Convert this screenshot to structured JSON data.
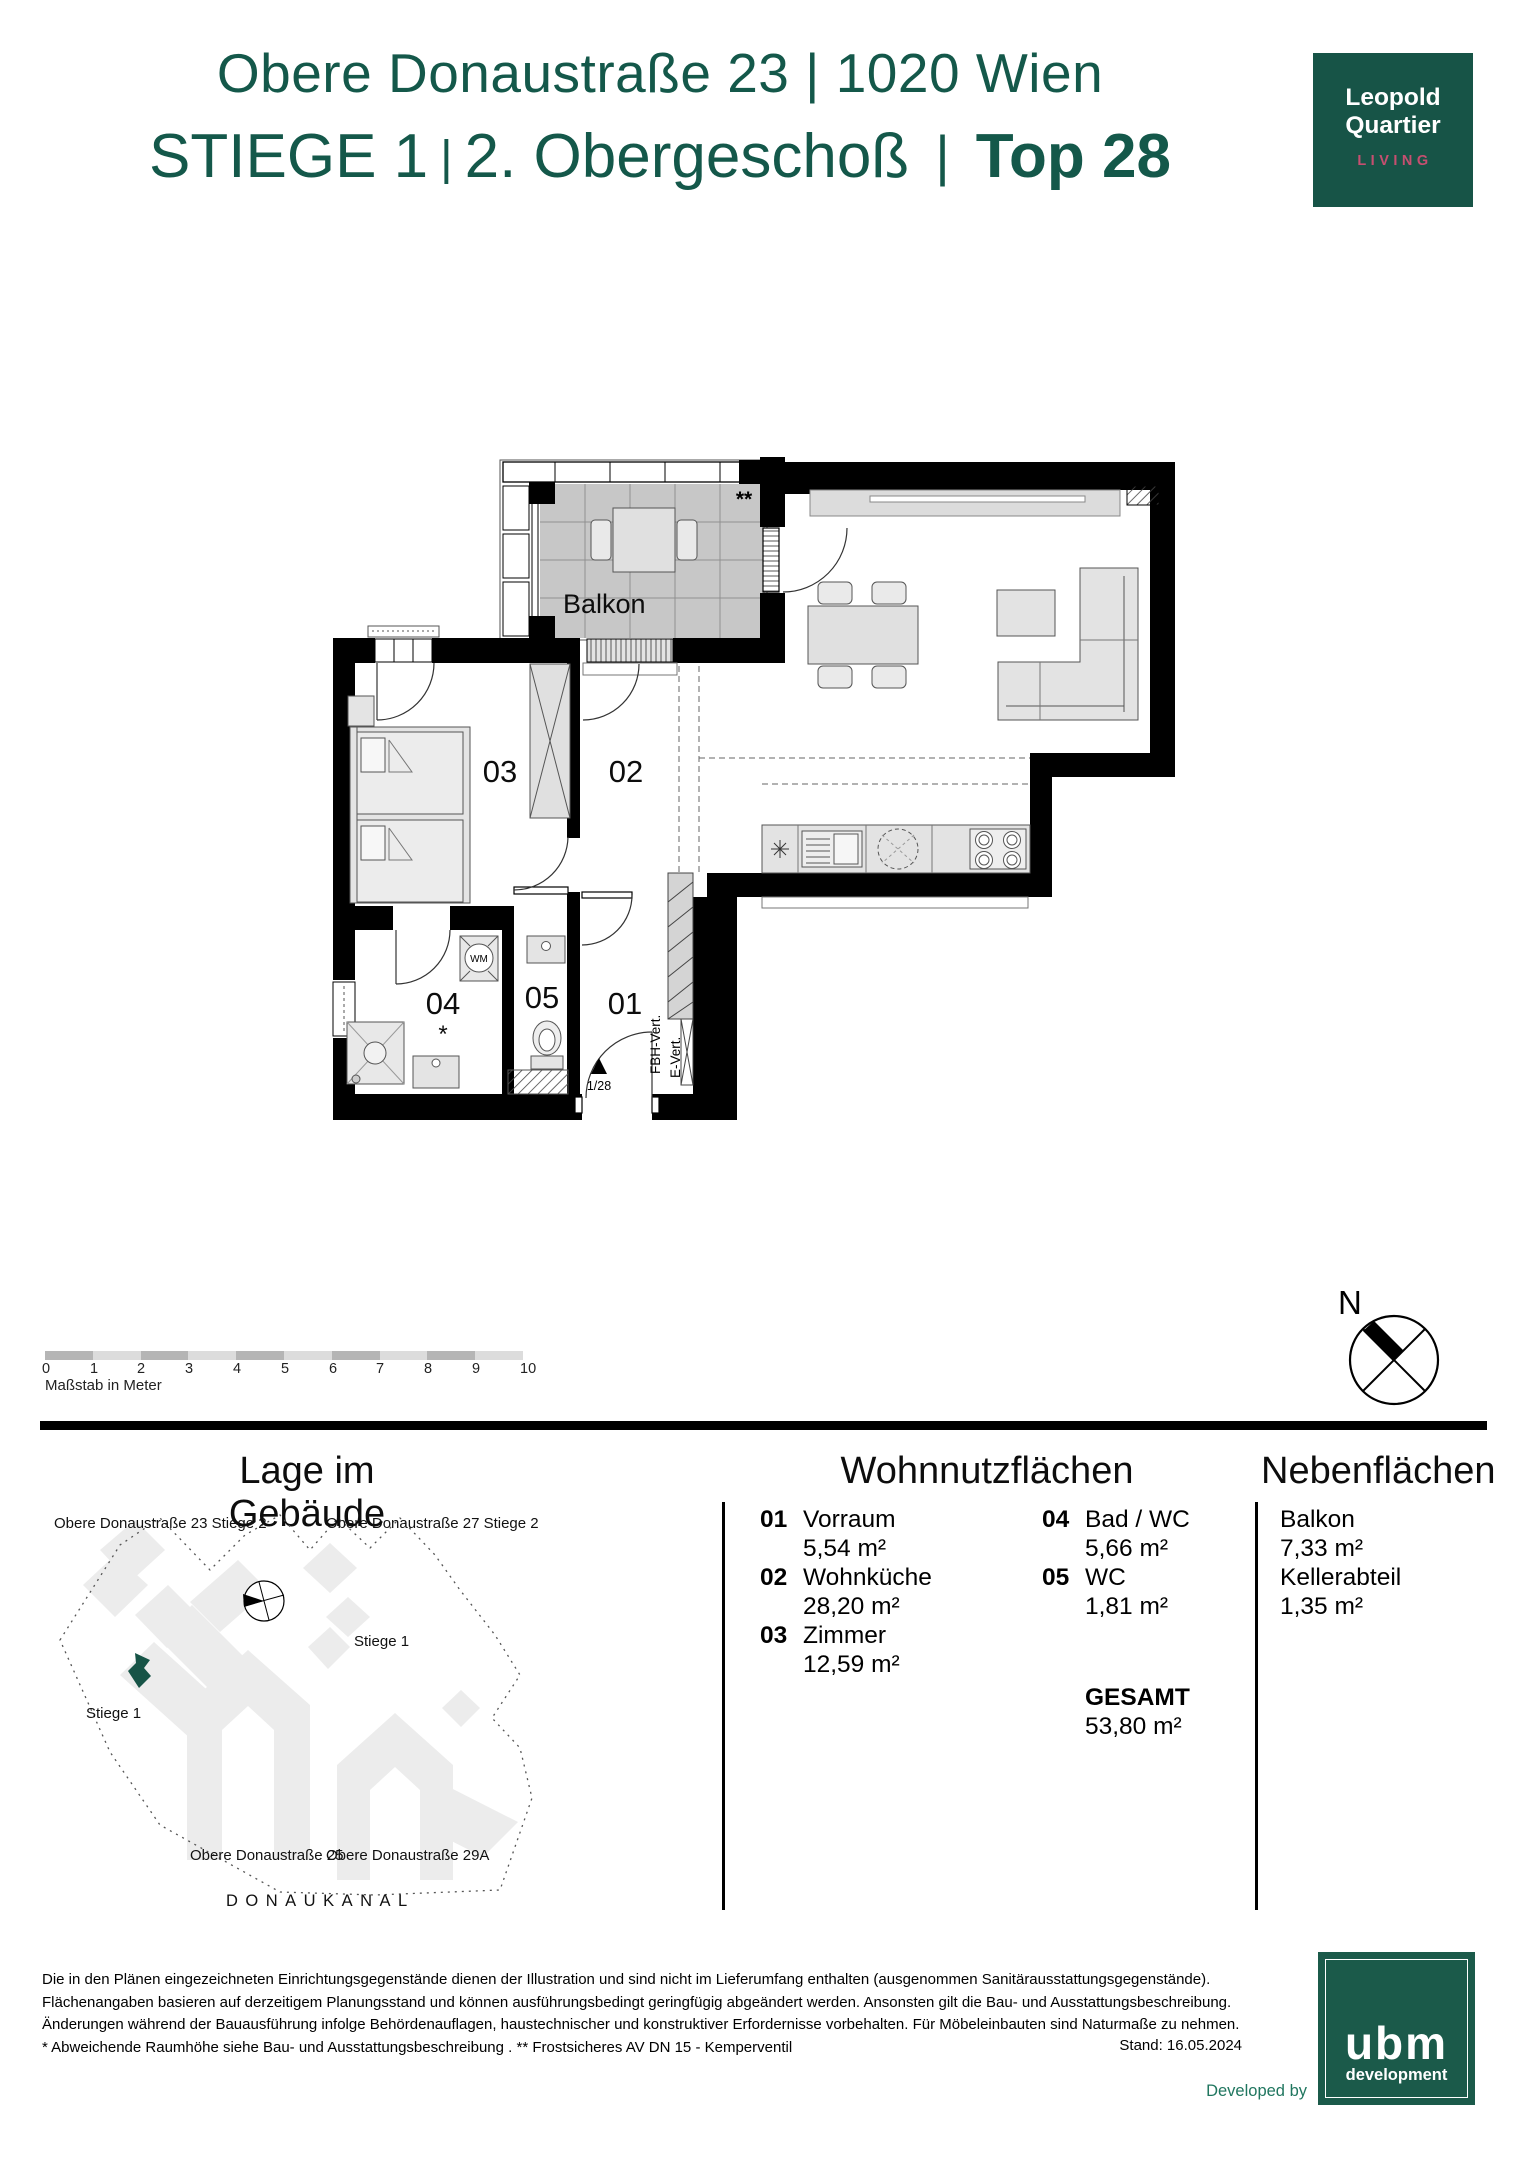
{
  "header": {
    "address": "Obere Donaustraße 23 | 1020 Wien",
    "title_part1": "STIEGE 1",
    "title_sep1": "|",
    "title_part2": "2. Obergeschoß",
    "title_sep2": "|",
    "title_part3": "Top 28"
  },
  "brand": {
    "line1": "Leopold",
    "line2": "Quartier",
    "tagline": "LIVING"
  },
  "plan": {
    "balcony_label": "Balkon",
    "room_labels": {
      "r01": "01",
      "r02": "02",
      "r03": "03",
      "r04": "04",
      "r05": "05"
    },
    "annotations": {
      "double_star": "**",
      "star": "*",
      "wm": "WM",
      "entrance_no": "1/28",
      "fbh": "FBH-Vert.",
      "evert": "E-Vert."
    }
  },
  "scalebar": {
    "ticks": [
      "0",
      "1",
      "2",
      "3",
      "4",
      "5",
      "6",
      "7",
      "8",
      "9",
      "10"
    ],
    "caption": "Maßstab in Meter"
  },
  "compass": {
    "north": "N"
  },
  "site_plan": {
    "title": "Lage im Gebäude",
    "labels": {
      "top_left": "Obere Donaustraße 23 Stiege 2",
      "top_right": "Obere Donaustraße 27 Stiege 2",
      "stiege_right": "Stiege 1",
      "stiege_left": "Stiege 1",
      "bottom_left": "Obere Donaustraße 25",
      "bottom_right": "Obere Donaustraße 29A",
      "canal": "DONAUKANAL"
    }
  },
  "areas": {
    "title": "Wohnnutzflächen",
    "col1": [
      {
        "no": "01",
        "name": "Vorraum",
        "area": "5,54 m²"
      },
      {
        "no": "02",
        "name": "Wohnküche",
        "area": "28,20 m²"
      },
      {
        "no": "03",
        "name": "Zimmer",
        "area": "12,59 m²"
      }
    ],
    "col2": [
      {
        "no": "04",
        "name": "Bad / WC",
        "area": "5,66 m²"
      },
      {
        "no": "05",
        "name": "WC",
        "area": "1,81 m²"
      }
    ],
    "total_label": "GESAMT",
    "total_area": "53,80 m²"
  },
  "secondary_areas": {
    "title": "Nebenflächen",
    "items": [
      {
        "name": "Balkon",
        "area": "7,33 m²"
      },
      {
        "name": "Kellerabteil",
        "area": "1,35 m²"
      }
    ]
  },
  "footer": {
    "lines": [
      "Die in den Plänen eingezeichneten Einrichtungsgegenstände dienen der Illustration und sind nicht im Lieferumfang enthalten (ausgenommen Sanitärausstattungsgegenstände).",
      "Flächenangaben basieren auf derzeitigem Planungsstand und können ausführungsbedingt geringfügig abgeändert werden. Ansonsten gilt die Bau- und Ausstattungsbeschreibung.",
      "Änderungen während der Bauausführung infolge Behördenauflagen, haustechnischer und konstruktiver Erfordernisse vorbehalten. Für Möbeleinbauten sind Naturmaße zu nehmen.",
      "* Abweichende Raumhöhe siehe Bau- und Ausstattungsbeschreibung . ** Frostsicheres AV DN 15 - Kemperventil"
    ],
    "stand": "Stand: 16.05.2024",
    "developed_by": "Developed by"
  },
  "ubm": {
    "name": "ubm",
    "subtitle": "development"
  },
  "colors": {
    "brand_green": "#175447",
    "accent_pink": "#c64f70"
  }
}
